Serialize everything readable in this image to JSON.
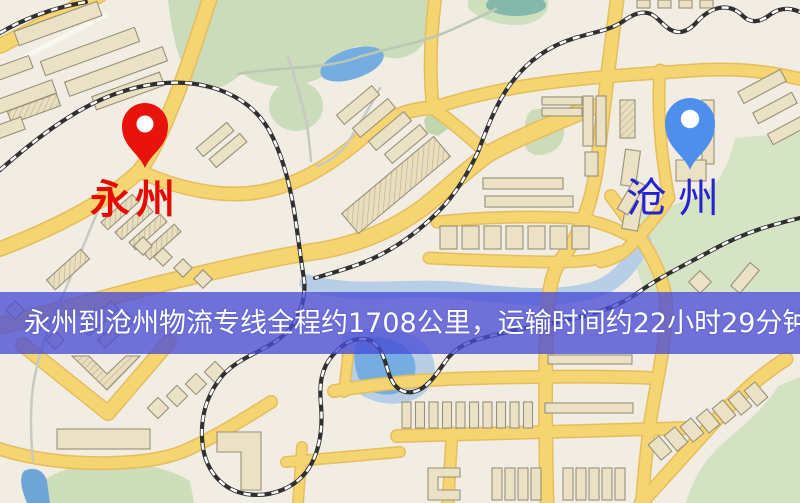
{
  "map": {
    "description_role": "static route map image",
    "origin": {
      "name": "永州",
      "marker_icon": "map-pin-icon",
      "marker_color": "#e8130c",
      "label_color": "#e60b00"
    },
    "destination": {
      "name": "沧州",
      "marker_icon": "map-pin-icon",
      "marker_color": "#4d8fea",
      "label_color": "#2323cf"
    },
    "banner": {
      "text": "永州到沧州物流专线全程约1708公里，运输时间约22小时29分钟.",
      "bg_color": "rgba(74,77,213,0.78)",
      "text_color": "#ffffff"
    },
    "palette": {
      "road_color": "#f5d472",
      "land_color": "#f1ede3",
      "park_color": "#cddcba",
      "water_color": "#76ade0",
      "building_color": "#ebe2c6",
      "railway_color": "#303030"
    }
  }
}
